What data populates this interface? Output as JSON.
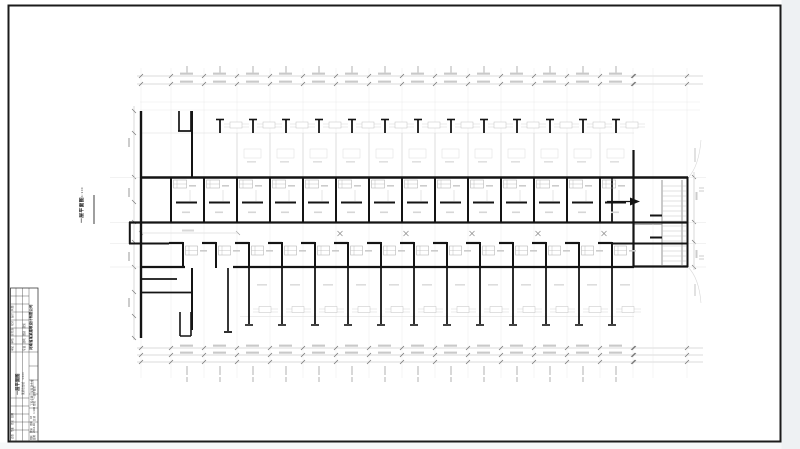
{
  "drawing_label": {
    "title": "一层平面图",
    "scale": "1:100"
  },
  "title_block": {
    "company": "河南省某某建筑设计有限公司",
    "roles_line": "审定 审核 总负责 校对 设计 制图",
    "majors_line": "专业 建筑 图别 建施",
    "big_title": "一层平面图",
    "big_sub": "某某宿舍楼 1:100",
    "project_line": "工程名称 某某宿舍楼",
    "name_line": "图名 一层平面图",
    "number_line": "图别 建施 图号 03",
    "date_line": "日期 2010.06 比例 1:100",
    "sign_line": "会签 专业 姓名 日期"
  },
  "colors": {
    "wall": "#141414",
    "axis_grid": "#e4e4e4",
    "dimension_line": "#b8b8b8",
    "light_detail": "#cfcfcf",
    "margin_strip": "#eef1f3",
    "frame": "#1b1b1b"
  },
  "plan": {
    "unit_pitch_px": 33,
    "repeats": [
      {
        "ref": "#u-axis",
        "layer": "lg",
        "name": "axis-gridline",
        "x0": 171,
        "dx": 33,
        "n": 15
      },
      {
        "ref": "#u-axis",
        "layer": "lg",
        "name": "axis-gridline",
        "xs": [
          141,
          653,
          687
        ]
      },
      {
        "ref": "#u-dimtick",
        "layer": "lg",
        "name": "dimension-ticks",
        "x0": 171,
        "dx": 33,
        "n": 15
      },
      {
        "ref": "#u-dimtick",
        "layer": "lg",
        "name": "dimension-ticks",
        "xs": [
          141,
          634,
          687
        ]
      },
      {
        "ref": "#u-dimnum",
        "layer": "lg",
        "name": "dimension-numbers",
        "x0": 171,
        "dx": 33,
        "n": 14
      },
      {
        "ref": "#u-vnum",
        "layer": "lg",
        "name": "axis-numbers",
        "x0": 187,
        "dx": 33,
        "n": 14
      },
      {
        "ref": "#u-balc",
        "layer": "lg",
        "name": "balcony-divider",
        "x0": 237,
        "dx": 33,
        "n": 12
      },
      {
        "ref": "#u-tread",
        "layer": "lg",
        "name": "stair-treads",
        "y0": 186,
        "dy": 5,
        "n": 16
      },
      {
        "ref": "#u-x",
        "layer": "lg",
        "name": "door-swing-mark",
        "xs": [
          340,
          406,
          472,
          538,
          604
        ]
      },
      {
        "ref": "#u-col",
        "layer": "st",
        "name": "veranda-column",
        "x0": 220,
        "dx": 33,
        "n": 13
      },
      {
        "ref": "#u-upper",
        "layer": "st",
        "name": "room-unit-upper",
        "x0": 171,
        "dx": 33,
        "n": 14
      },
      {
        "ref": "#u-lower",
        "layer": "st",
        "name": "room-unit-lower",
        "x0": 183,
        "dx": 33,
        "n": 14
      },
      {
        "ref": "#u-c2seg",
        "layer": "st",
        "name": "corridor-door-wall",
        "x0": 183,
        "dx": 33,
        "n": 14
      },
      {
        "ref": "#u-bottom",
        "layer": "st",
        "name": "porch-column-unit",
        "x0": 249,
        "dx": 33,
        "n": 12
      }
    ]
  }
}
